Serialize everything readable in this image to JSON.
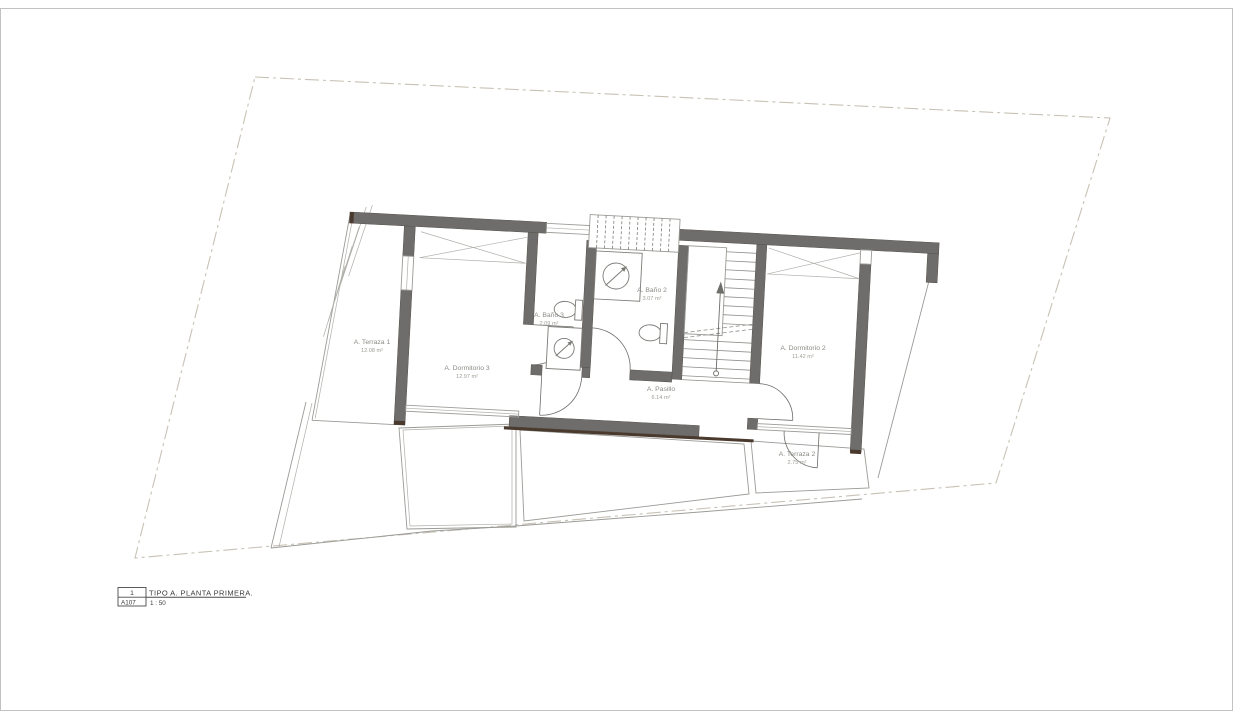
{
  "sheet": {
    "background": "#ffffff",
    "page_border_color": "#c2c2c2",
    "boundary_color": "#c8c2b6",
    "wall_color": "#6e6d6b",
    "wall_cap_color": "#4a3a2e",
    "thin_line_color": "#9a9a96",
    "label_color": "#8c8b85"
  },
  "rooms": [
    {
      "name": "A. Terraza 1",
      "area": "12.08 m²"
    },
    {
      "name": "A. Dormitorio 3",
      "area": "12.97 m²"
    },
    {
      "name": "A. Baño 3",
      "area": "2.09 m²"
    },
    {
      "name": "A. Baño 2",
      "area": "3.07 m²"
    },
    {
      "name": "A. Pasillo",
      "area": "6.14 m²"
    },
    {
      "name": "A. Dormitorio 2",
      "area": "11.42 m²"
    },
    {
      "name": "A. Terraza 2",
      "area": "2.75 m²"
    }
  ],
  "title_block": {
    "detail_number": "1",
    "sheet_number": "A107",
    "title": "TIPO A. PLANTA PRIMERA.",
    "scale": "1 : 50"
  }
}
